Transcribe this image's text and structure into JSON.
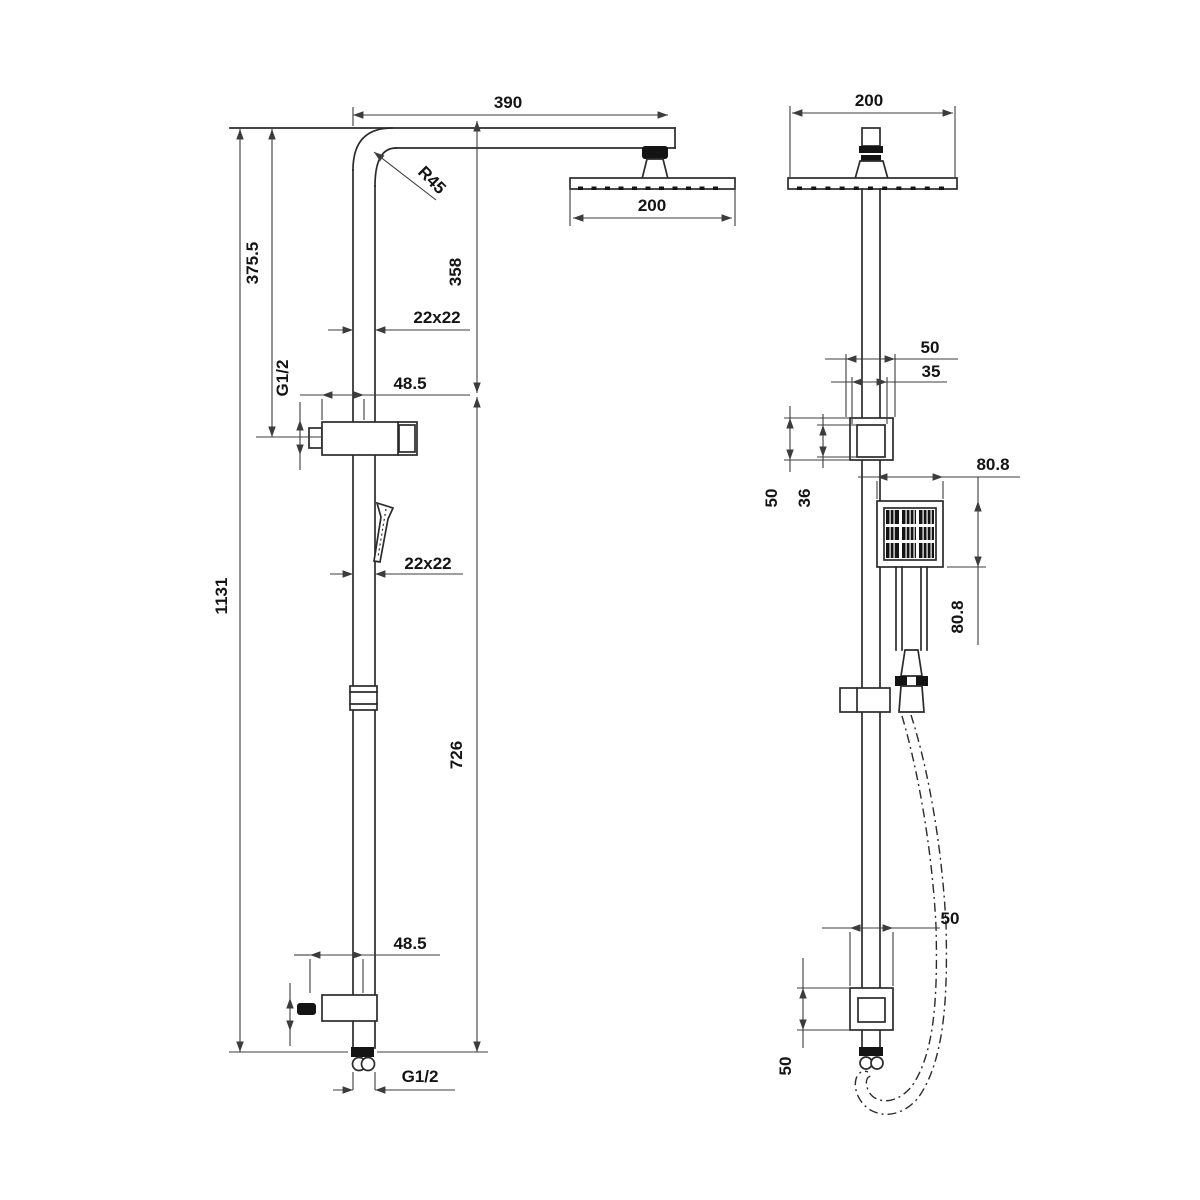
{
  "drawing": {
    "colors": {
      "line": "#2b2b2b",
      "dimension": "#3c3c3c",
      "text": "#141414",
      "background": "#ffffff"
    },
    "side_view": {
      "arm_reach": "390",
      "head_size": "200",
      "bend_radius": "R45",
      "upper_height": "375.5",
      "head_drop": "358",
      "pipe_section_upper": "22x22",
      "inlet_thread_upper": "G1/2",
      "bracket_offset_upper": "48.5",
      "total_height": "1131",
      "pipe_section_lower": "22x22",
      "lower_height": "726",
      "bracket_offset_lower": "48.5",
      "inlet_thread_lower": "G1/2"
    },
    "front_view": {
      "head_size": "200",
      "bracket_width_upper": "50",
      "bracket_inner_width_upper": "35",
      "bracket_height_upper": "50",
      "bracket_inner_height_upper": "36",
      "handset_width": "80.8",
      "handset_height": "80.8",
      "bracket_width_lower": "50",
      "bracket_height_lower": "50"
    }
  }
}
